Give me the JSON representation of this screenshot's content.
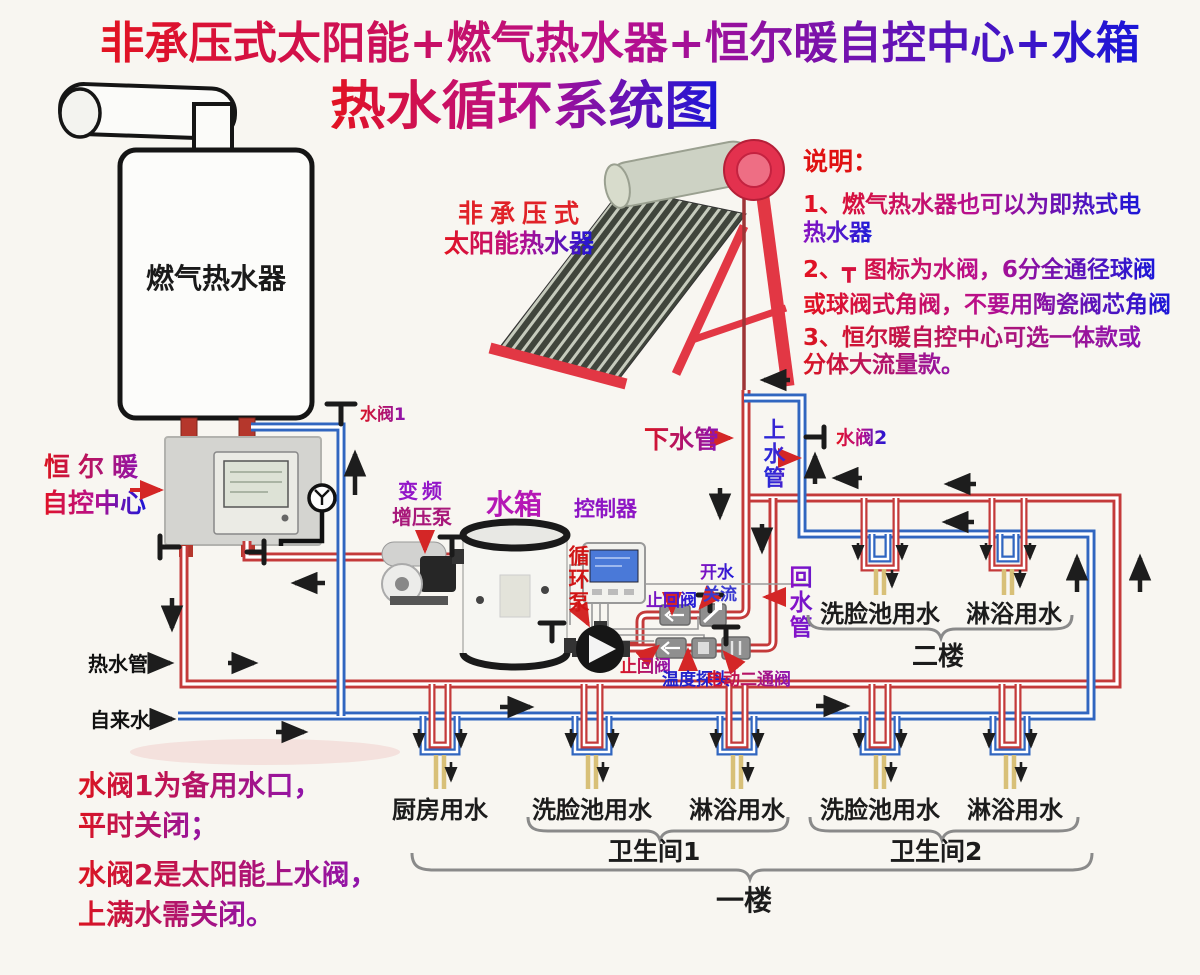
{
  "title": {
    "line1": "非承压式太阳能+燃气热水器+恒尔暖自控中心+水箱",
    "line2": "热水循环系统图"
  },
  "solar": {
    "label_line1": "非承压式",
    "label_line2": "太阳能热水器"
  },
  "gas_heater": {
    "label": "燃气热水器"
  },
  "control_center": {
    "label_line1": "恒尔暖",
    "label_line2": "自控中心"
  },
  "notes_right": {
    "heading": "说明：",
    "item1_line1": "1、燃气热水器也可以为即热式电",
    "item1_line2": "热水器",
    "item2_line1": "2、┳ 图标为水阀，6分全通径球阀",
    "item2_line2": "或球阀式角阀，不要用陶瓷阀芯角阀",
    "item3_line1": "3、恒尔暖自控中心可选一体款或",
    "item3_line2": "分体大流量款。"
  },
  "notes_left": {
    "line1": "水阀1为备用水口，",
    "line2": "平时关闭；",
    "line3": "水阀2是太阳能上水阀，",
    "line4": "上满水需关闭。"
  },
  "components": {
    "booster_pump_line1": "变频",
    "booster_pump_line2": "增压泵",
    "water_tank": "水箱",
    "controller": "控制器",
    "circulation_pump": "循环泵",
    "check_valve": "止回阀",
    "open_close_line1": "开水",
    "open_close_line2": "关流",
    "temp_probe": "温度探头",
    "electric_valve": "电动二通阀"
  },
  "pipes": {
    "valve1": "水阀1",
    "valve2": "水阀2",
    "down_pipe": "下水管",
    "up_pipe": "上水管",
    "return_pipe": "回水管",
    "hot_water_pipe": "热水管",
    "tap_water": "自来水"
  },
  "outlets": {
    "kitchen": "厨房用水",
    "basin": "洗脸池用水",
    "shower": "淋浴用水",
    "bathroom1": "卫生间1",
    "bathroom2": "卫生间2",
    "floor1": "一楼",
    "floor2": "二楼"
  },
  "colors": {
    "hot_pipe": "#c43a3a",
    "cold_pipe": "#3166c0",
    "solar_frame": "#e23744",
    "accent_red": "#d01616",
    "accent_purple": "#8d14c4",
    "accent_blue": "#2222cc"
  }
}
